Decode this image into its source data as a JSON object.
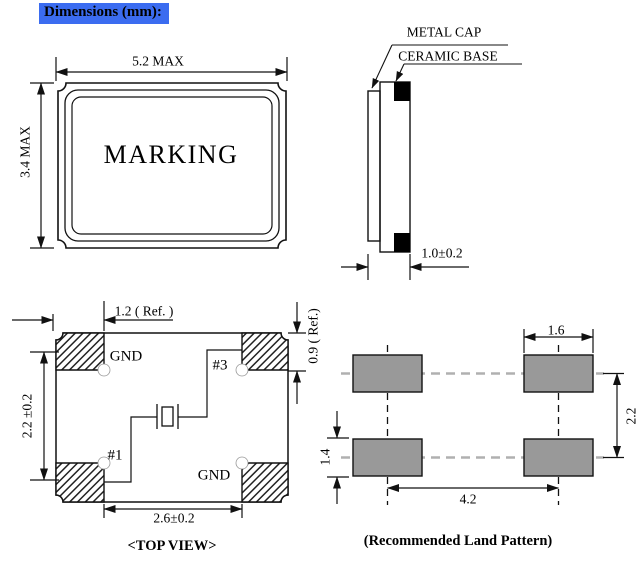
{
  "title": "Dimensions (mm):",
  "colors": {
    "highlight_blue": "#3b6cf0",
    "pad_gray": "#999999",
    "line_black": "#111111",
    "gray_dash": "#b0b0b0"
  },
  "front_view": {
    "width_dim": "5.2 MAX",
    "height_dim": "3.4 MAX",
    "marking": "MARKING"
  },
  "side_view": {
    "cap_label": "METAL CAP",
    "base_label": "CERAMIC BASE",
    "thickness_dim": "1.0±0.2"
  },
  "top_view": {
    "caption": "<TOP VIEW>",
    "pad_top_left": "GND",
    "pad_top_right": "#3",
    "pad_bottom_left": "#1",
    "pad_bottom_right": "GND",
    "dim_pad_width": "1.2 ( Ref. )",
    "dim_pad_pitch_vertical": "2.2 ±0.2",
    "dim_pad_height": "0.9 ( Ref.)",
    "dim_inner_span": "2.6±0.2"
  },
  "land_pattern": {
    "caption": "(Recommended Land Pattern)",
    "dim_pad_width": "1.6",
    "dim_row_pitch": "2.2",
    "dim_pad_height": "1.4",
    "dim_col_pitch": "4.2"
  }
}
